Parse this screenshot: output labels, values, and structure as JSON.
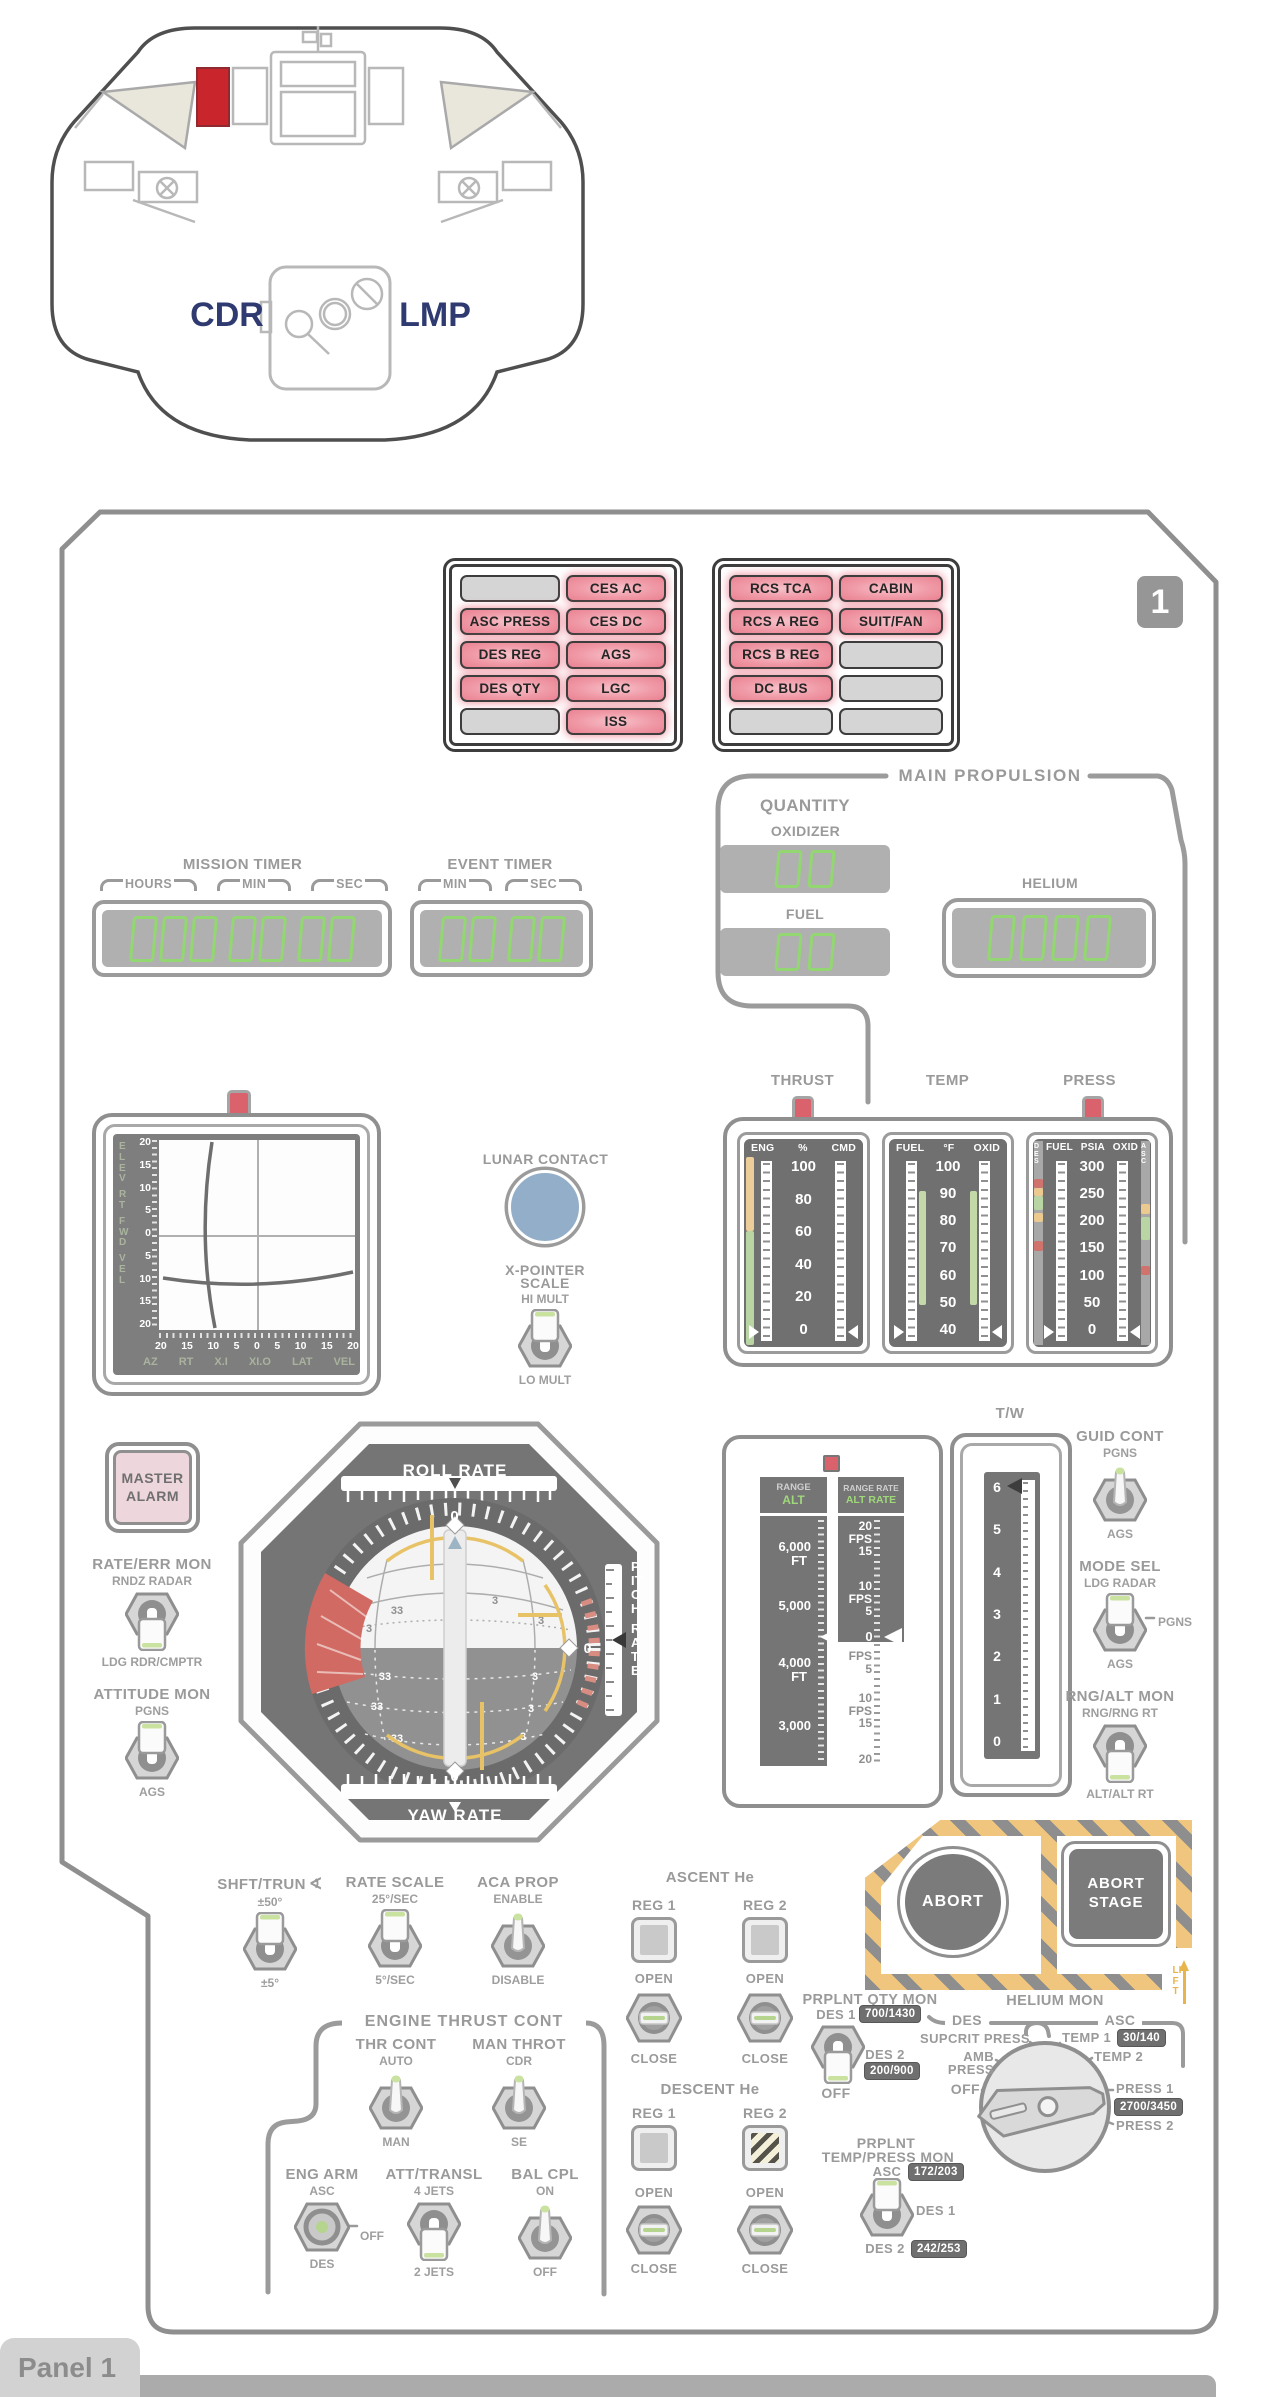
{
  "page": {
    "tab_label": "Panel 1",
    "panel_badge": "1"
  },
  "cabin": {
    "cdr": "CDR",
    "lmp": "LMP"
  },
  "caution": {
    "left": [
      [
        "",
        "CES AC"
      ],
      [
        "ASC PRESS",
        "CES DC"
      ],
      [
        "DES REG",
        "AGS"
      ],
      [
        "DES QTY",
        "LGC"
      ],
      [
        "",
        "ISS"
      ]
    ],
    "right": [
      [
        "RCS TCA",
        "CABIN"
      ],
      [
        "RCS A REG",
        "SUIT/FAN"
      ],
      [
        "RCS B REG",
        ""
      ],
      [
        "DC BUS",
        ""
      ],
      [
        "",
        ""
      ]
    ]
  },
  "timers": {
    "mission_title": "MISSION TIMER",
    "mission_units": [
      "HOURS",
      "MIN",
      "SEC"
    ],
    "event_title": "EVENT TIMER",
    "event_units": [
      "MIN",
      "SEC"
    ]
  },
  "main_prop": {
    "title": "MAIN PROPULSION",
    "quantity": "QUANTITY",
    "oxidizer": "OXIDIZER",
    "fuel": "FUEL",
    "helium": "HELIUM"
  },
  "xpointer": {
    "scale": [
      "20",
      "15",
      "10",
      "5",
      "0"
    ],
    "side_words": [
      "ELEV",
      "RT",
      "FWD",
      "VEL"
    ],
    "bottom_labels": [
      "AZ",
      "RT",
      "X.I",
      "XI.O",
      "LAT",
      "VEL"
    ],
    "lunar_contact": "LUNAR CONTACT",
    "scale_line1": "X-POINTER",
    "scale_line2": "SCALE",
    "hi": "HI MULT",
    "lo": "LO MULT"
  },
  "gauges": {
    "thrust": {
      "title": "THRUST",
      "c1": "ENG",
      "c2": "%",
      "c3": "CMD",
      "scale": [
        "100",
        "80",
        "60",
        "40",
        "20",
        "0"
      ]
    },
    "temp": {
      "title": "TEMP",
      "c1": "FUEL",
      "c2": "°F",
      "c3": "OXID",
      "scale": [
        "100",
        "90",
        "80",
        "70",
        "60",
        "50",
        "40"
      ]
    },
    "press": {
      "title": "PRESS",
      "c1": "FUEL",
      "c2": "PSIA",
      "c3": "OXID",
      "scale": [
        "300",
        "250",
        "200",
        "150",
        "100",
        "50",
        "0"
      ],
      "left_edge": "DES",
      "right_edge": "ASC"
    }
  },
  "fdai": {
    "roll": "ROLL RATE",
    "yaw": "YAW RATE",
    "pitch_words": [
      "PITCH",
      "RATE"
    ],
    "zero": "0",
    "n33": "33",
    "n3": "3"
  },
  "master_alarm": {
    "l1": "MASTER",
    "l2": "ALARM"
  },
  "left_switches": {
    "rate_err": {
      "title": "RATE/ERR MON",
      "top": "RNDZ RADAR",
      "bottom": "LDG RDR/CMPTR"
    },
    "att_mon": {
      "title": "ATTITUDE MON",
      "top": "PGNS",
      "bottom": "AGS"
    }
  },
  "tape": {
    "range": "RANGE",
    "alt": "ALT",
    "range_rate": "RANGE RATE",
    "alt_rate": "ALT RATE",
    "ft": "FT",
    "fps": "FPS",
    "alt_vals": [
      "6,000",
      "5,000",
      "4,000",
      "3,000"
    ],
    "rv": [
      "20",
      "15",
      "10",
      "5",
      "0"
    ]
  },
  "tw": {
    "title": "T/W",
    "scale": [
      "6",
      "5",
      "4",
      "3",
      "2",
      "1",
      "0"
    ]
  },
  "right_switches": {
    "guid": {
      "title": "GUID CONT",
      "top": "PGNS",
      "bottom": "AGS"
    },
    "mode": {
      "title": "MODE SEL",
      "top": "LDG RADAR",
      "right": "PGNS",
      "bottom": "AGS"
    },
    "rngalt": {
      "title": "RNG/ALT MON",
      "top": "RNG/RNG RT",
      "bottom": "ALT/ALT RT"
    }
  },
  "abort": {
    "abort": "ABORT",
    "stage_l1": "ABORT",
    "stage_l2": "STAGE",
    "lift": "LIFT"
  },
  "mid_switches": {
    "shft": {
      "title": "SHFT/TRUN",
      "icon": "∢",
      "top": "±50°",
      "bottom": "±5°"
    },
    "rate_scale": {
      "title": "RATE SCALE",
      "top": "25°/SEC",
      "bottom": "5°/SEC"
    },
    "aca": {
      "title": "ACA PROP",
      "top": "ENABLE",
      "bottom": "DISABLE"
    }
  },
  "ascent_he": {
    "title": "ASCENT He",
    "reg1": "REG 1",
    "reg2": "REG 2",
    "open": "OPEN",
    "close": "CLOSE"
  },
  "descent_he": {
    "title": "DESCENT He",
    "reg1": "REG 1",
    "reg2": "REG 2",
    "open": "OPEN",
    "close": "CLOSE"
  },
  "etc": {
    "title": "ENGINE THRUST CONT",
    "thr": {
      "title": "THR CONT",
      "top": "AUTO",
      "bottom": "MAN"
    },
    "man": {
      "title": "MAN THROT",
      "top": "CDR",
      "bottom": "SE"
    },
    "eng_arm": {
      "title": "ENG ARM",
      "top": "ASC",
      "right": "OFF",
      "bottom": "DES"
    },
    "att": {
      "title": "ATT/TRANSL",
      "top": "4 JETS",
      "bottom": "2 JETS"
    },
    "bal": {
      "title": "BAL CPL",
      "top": "ON",
      "bottom": "OFF"
    }
  },
  "qty_mon": {
    "title": "PRPLNT QTY MON",
    "des1": "DES 1",
    "des1_val": "700/1430",
    "des2": "DES 2",
    "des2_val": "200/900",
    "off": "OFF"
  },
  "helium_mon": {
    "title": "HELIUM MON",
    "des": "DES",
    "asc": "ASC",
    "supcrit": "SUPCRIT PRESS",
    "amb_l1": "AMB",
    "amb_l2": "PRESS",
    "off": "OFF",
    "temp1": "TEMP 1",
    "temp1_val": "30/140",
    "temp2": "TEMP 2",
    "press1": "PRESS 1",
    "press1_val": "2700/3450",
    "press2": "PRESS 2"
  },
  "tp_mon": {
    "l1": "PRPLNT",
    "l2": "TEMP/PRESS MON",
    "asc": "ASC",
    "asc_val": "172/203",
    "des1": "DES 1",
    "des2": "DES 2",
    "des2_val": "242/253"
  },
  "colors": {
    "accent_red": "#c9252c",
    "light_pink": "#ef93a1",
    "digit_green": "#93d773",
    "hazard_yellow": "#f0c67e",
    "contact_blue": "#93aec8",
    "navy": "#2e3a70",
    "indicator_red": "#d9626c"
  }
}
